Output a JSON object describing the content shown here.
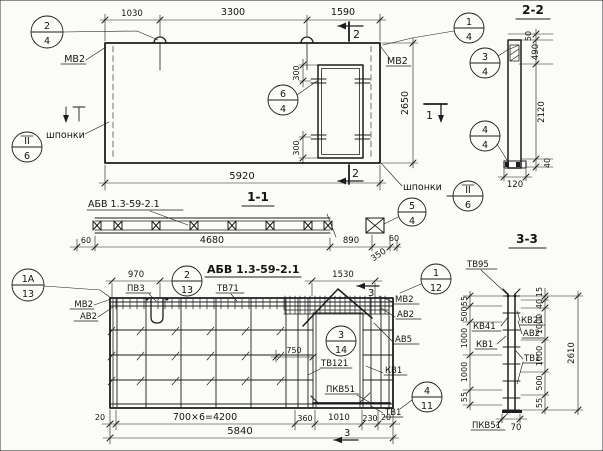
{
  "elevation": {
    "dims": {
      "top_left": "1030",
      "top_mid": "3300",
      "top_right": "1590",
      "width": "5920",
      "height": "2650",
      "opening_top": "300",
      "opening_bottom": "300"
    },
    "labels": {
      "mv2_left": "МВ2",
      "mv2_right": "МВ2",
      "keys_left": "шпонки",
      "keys_right": "шпонки"
    },
    "marks": {
      "cut2_top": "2",
      "cut2_bottom": "2",
      "cut1": "1"
    },
    "callouts": {
      "pos2": {
        "top": "2",
        "bottom": "4"
      },
      "pos1": {
        "top": "1",
        "bottom": "4"
      },
      "pos6": {
        "top": "6",
        "bottom": "4"
      },
      "sheet_left": {
        "top": "II",
        "bottom": "6"
      },
      "sheet_right": {
        "top": "II",
        "bottom": "6"
      }
    }
  },
  "section22": {
    "title": "2-2",
    "dims": {
      "d50": "50",
      "d490": "490",
      "d2120": "2120",
      "d40": "40",
      "width": "120"
    },
    "callouts": {
      "pos3": {
        "top": "3",
        "bottom": "4"
      },
      "pos4": {
        "top": "4",
        "bottom": "4"
      }
    }
  },
  "section11": {
    "title": "1-1",
    "panel_mark": "АБВ 1.3-59-2.1",
    "dims": {
      "left": "60",
      "core": "4680",
      "gap": "890",
      "end": "350",
      "right": "60"
    },
    "callouts": {
      "pos5": {
        "top": "5",
        "bottom": "4"
      }
    }
  },
  "plan": {
    "title": "АБВ 1.3-59-2.1",
    "dims": {
      "d970": "970",
      "d1530": "1530",
      "d750": "750",
      "d20_left": "20",
      "d4200": "700×6=4200",
      "d360": "360",
      "d1010": "1010",
      "d230": "230",
      "d20_right": "20",
      "total": "5840"
    },
    "labels": {
      "pv3": "ПВ3",
      "tv71": "ТВ71",
      "mv2_left": "МВ2",
      "av2_left": "АВ2",
      "mv2_right": "МВ2",
      "av2_right": "АВ2",
      "av5": "АВ5",
      "kv1": "КВ1",
      "tv121": "ТВ121",
      "pkv51": "ПКВ51",
      "tv1": "ТВ1"
    },
    "marks": {
      "cut3_top": "3",
      "cut3_bottom": "3"
    },
    "callouts": {
      "pos1a": {
        "top": "1А",
        "bottom": "13"
      },
      "pos2": {
        "top": "2",
        "bottom": "13"
      },
      "pos3": {
        "top": "3",
        "bottom": "14"
      },
      "pos1": {
        "top": "1",
        "bottom": "12"
      },
      "pos4": {
        "top": "4",
        "bottom": "11"
      }
    }
  },
  "section33": {
    "title": "3-3",
    "bar_label": "ТВ95",
    "dims_left": [
      "55",
      "500",
      "1000",
      "1000",
      "55"
    ],
    "dims_right": [
      "15",
      "40",
      "1000",
      "1000",
      "500",
      "55"
    ],
    "total": "2610",
    "width": "70",
    "labels": {
      "kv41": "КВ41",
      "kv21": "КВ21",
      "av2": "АВ2",
      "kv1": "КВ1",
      "tv1": "ТВ1",
      "pkv51": "ПКВ51"
    }
  }
}
